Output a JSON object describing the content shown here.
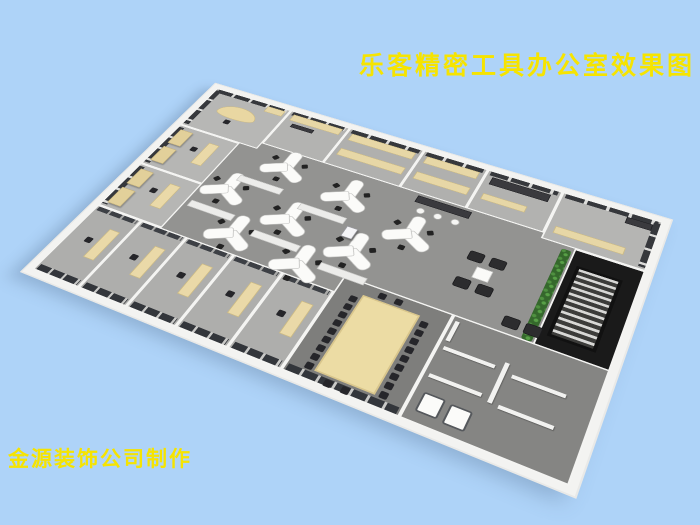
{
  "title": {
    "text": "乐客精密工具办公室效果图",
    "color": "#f6e400"
  },
  "credit": {
    "text": "金源装饰公司制作",
    "color": "#f6e400"
  },
  "palette": {
    "background": "#aed3f8",
    "wall_white": "#f3f3f1",
    "floor_open": "#939391",
    "floor_office": "#b4b4b2",
    "floor_conference": "#7e7e7c",
    "glass_dark": "#3a3d42",
    "furniture_wood": "#e7d7a6",
    "plant_green": "#3c7a30",
    "chair_black": "#26262a"
  },
  "scene": {
    "camera": {
      "perspective": 900,
      "rotateX": 45,
      "rotateZ": 26,
      "scale": 0.84,
      "left": 28,
      "top": 37,
      "w": 640,
      "h": 400
    },
    "rooms": [
      {
        "name": "room-manager-nw",
        "x": 0,
        "y": 0,
        "w": 122,
        "h": 95,
        "floor": "#b7b7b5",
        "cls": "win-n win-w"
      },
      {
        "name": "room-office-n1",
        "x": 122,
        "y": 0,
        "w": 92,
        "h": 82,
        "floor": "#b3b3b1",
        "cls": "win-n"
      },
      {
        "name": "room-storage-n1",
        "x": 214,
        "y": 0,
        "w": 110,
        "h": 82,
        "floor": "#b0b0ae",
        "cls": "win-n"
      },
      {
        "name": "room-storage-n2",
        "x": 324,
        "y": 0,
        "w": 90,
        "h": 82,
        "floor": "#b0b0ae",
        "cls": "win-n"
      },
      {
        "name": "room-office-n2",
        "x": 414,
        "y": 0,
        "w": 100,
        "h": 82,
        "floor": "#b2b2b0",
        "cls": "win-n"
      },
      {
        "name": "room-ne",
        "x": 514,
        "y": 0,
        "w": 126,
        "h": 92,
        "floor": "#b5b5b3",
        "cls": "win-n win-e"
      },
      {
        "name": "room-office-w1",
        "x": 0,
        "y": 95,
        "w": 95,
        "h": 92,
        "floor": "#b6b6b4",
        "cls": "win-w"
      },
      {
        "name": "room-office-w2",
        "x": 0,
        "y": 187,
        "w": 95,
        "h": 90,
        "floor": "#b6b6b4",
        "cls": "win-w"
      },
      {
        "name": "room-office-s1",
        "x": 0,
        "y": 277,
        "w": 66,
        "h": 123,
        "floor": "#aeaeac",
        "cls": "glass-n glass-s"
      },
      {
        "name": "room-office-s2",
        "x": 66,
        "y": 277,
        "w": 66,
        "h": 123,
        "floor": "#aeaeac",
        "cls": "glass-n glass-s"
      },
      {
        "name": "room-office-s3",
        "x": 132,
        "y": 277,
        "w": 66,
        "h": 123,
        "floor": "#aeaeac",
        "cls": "glass-n glass-s"
      },
      {
        "name": "room-office-s4",
        "x": 198,
        "y": 277,
        "w": 66,
        "h": 123,
        "floor": "#aeaeac",
        "cls": "glass-n glass-s"
      },
      {
        "name": "room-office-s5",
        "x": 264,
        "y": 277,
        "w": 66,
        "h": 123,
        "floor": "#aeaeac",
        "cls": "glass-n glass-s"
      },
      {
        "name": "room-conference",
        "x": 330,
        "y": 250,
        "w": 135,
        "h": 150,
        "floor": "#7e7e7c",
        "cls": "glass-s"
      },
      {
        "name": "room-restrooms-se",
        "x": 465,
        "y": 250,
        "w": 175,
        "h": 150,
        "floor": "#858583",
        "cls": ""
      },
      {
        "name": "room-stairwell",
        "x": 556,
        "y": 92,
        "w": 84,
        "h": 160,
        "floor": "#1a1a1a",
        "cls": ""
      }
    ],
    "items": [
      {
        "type": "curvedesk",
        "name": "reception-curved-desk",
        "x": 28,
        "y": 26,
        "w": 60,
        "h": 28
      },
      {
        "type": "chair",
        "name": "office-chair",
        "x": 50,
        "y": 58
      },
      {
        "type": "shelf",
        "name": "sideboard",
        "x": 88,
        "y": 6,
        "w": 28,
        "h": 13
      },
      {
        "type": "shelf",
        "name": "sideboard",
        "x": 130,
        "y": 7,
        "w": 76,
        "h": 14
      },
      {
        "type": "counter",
        "name": "dark-counter",
        "x": 138,
        "y": 26,
        "w": 34,
        "h": 8
      },
      {
        "type": "shelf",
        "name": "storage-shelf",
        "x": 222,
        "y": 10,
        "w": 94,
        "h": 15
      },
      {
        "type": "shelf",
        "name": "storage-shelf",
        "x": 222,
        "y": 44,
        "w": 94,
        "h": 15
      },
      {
        "type": "shelf",
        "name": "storage-shelf",
        "x": 332,
        "y": 10,
        "w": 74,
        "h": 15
      },
      {
        "type": "shelf",
        "name": "storage-shelf",
        "x": 332,
        "y": 44,
        "w": 74,
        "h": 15
      },
      {
        "type": "darkdesk",
        "name": "dark-desk",
        "x": 424,
        "y": 12,
        "w": 78,
        "h": 15
      },
      {
        "type": "shelf",
        "name": "storage-shelf",
        "x": 424,
        "y": 46,
        "w": 58,
        "h": 12
      },
      {
        "type": "shelf",
        "name": "sideboard",
        "x": 524,
        "y": 64,
        "w": 86,
        "h": 13
      },
      {
        "type": "darkdesk",
        "name": "dark-desk",
        "x": 598,
        "y": 10,
        "w": 32,
        "h": 12
      },
      {
        "type": "cabinet",
        "name": "wardrobe-cabinet",
        "x": 7,
        "y": 104,
        "w": 20,
        "h": 32,
        "repeat": 2,
        "dx": 0,
        "dy": 40
      },
      {
        "type": "desk",
        "name": "office-desk",
        "x": 58,
        "y": 112,
        "w": 16,
        "h": 46
      },
      {
        "type": "chair",
        "name": "office-chair",
        "x": 42,
        "y": 128
      },
      {
        "type": "cabinet",
        "name": "wardrobe-cabinet",
        "x": 7,
        "y": 196,
        "w": 20,
        "h": 32,
        "repeat": 2,
        "dx": 0,
        "dy": 40
      },
      {
        "type": "desk",
        "name": "office-desk",
        "x": 58,
        "y": 204,
        "w": 16,
        "h": 46
      },
      {
        "type": "chair",
        "name": "office-chair",
        "x": 42,
        "y": 220
      },
      {
        "type": "desk",
        "name": "office-desk",
        "x": 40,
        "y": 306,
        "w": 15,
        "h": 52,
        "repeat": 5,
        "dx": 66,
        "dy": 0
      },
      {
        "type": "chair",
        "name": "office-chair",
        "x": 24,
        "y": 328,
        "repeat": 5,
        "dx": 66,
        "dy": 0
      },
      {
        "type": "ydesk",
        "name": "y-workstation",
        "x": 175,
        "y": 112
      },
      {
        "type": "ydesk",
        "name": "y-workstation",
        "x": 272,
        "y": 127
      },
      {
        "type": "ydesk",
        "name": "y-workstation",
        "x": 370,
        "y": 155
      },
      {
        "type": "ydesk",
        "name": "y-workstation",
        "x": 128,
        "y": 182
      },
      {
        "type": "ydesk",
        "name": "y-workstation",
        "x": 225,
        "y": 197
      },
      {
        "type": "ydesk",
        "name": "y-workstation",
        "x": 320,
        "y": 212
      },
      {
        "type": "ydesk",
        "name": "y-workstation",
        "x": 176,
        "y": 248
      },
      {
        "type": "ydesk",
        "name": "y-workstation",
        "x": 272,
        "y": 258
      },
      {
        "type": "lowcab",
        "name": "low-cabinet",
        "x": 130,
        "y": 150,
        "w": 64,
        "h": 12
      },
      {
        "type": "lowcab",
        "name": "low-cabinet",
        "x": 226,
        "y": 163,
        "w": 64,
        "h": 12
      },
      {
        "type": "lowcab",
        "name": "low-cabinet",
        "x": 100,
        "y": 218,
        "w": 64,
        "h": 12
      },
      {
        "type": "lowcab",
        "name": "low-cabinet",
        "x": 198,
        "y": 230,
        "w": 64,
        "h": 12
      },
      {
        "type": "lowcab",
        "name": "low-cabinet",
        "x": 296,
        "y": 243,
        "w": 60,
        "h": 12
      },
      {
        "type": "printer",
        "name": "copier-machine",
        "x": 296,
        "y": 175,
        "w": 15,
        "h": 19
      },
      {
        "type": "counter",
        "name": "bar-counter",
        "x": 352,
        "y": 86,
        "w": 72,
        "h": 13
      },
      {
        "type": "stool",
        "name": "bar-stool",
        "x": 360,
        "y": 106,
        "repeat": 3,
        "dx": 23,
        "dy": 0
      },
      {
        "type": "armchair",
        "name": "lounge-armchair",
        "x": 446,
        "y": 148,
        "repeat": 2,
        "dx": 27,
        "dy": 0
      },
      {
        "type": "armchair",
        "name": "lounge-armchair",
        "x": 446,
        "y": 194,
        "repeat": 2,
        "dx": 27,
        "dy": 0
      },
      {
        "type": "ctable",
        "name": "coffee-table",
        "x": 462,
        "y": 170,
        "w": 20,
        "h": 19
      },
      {
        "type": "plant",
        "name": "green-plant-wall",
        "x": 542,
        "y": 98,
        "w": 12,
        "h": 152
      },
      {
        "type": "stairs",
        "name": "staircase",
        "x": 566,
        "y": 118,
        "w": 54,
        "h": 116
      },
      {
        "type": "armchair",
        "name": "waiting-armchair",
        "x": 516,
        "y": 226,
        "repeat": 2,
        "dx": 25,
        "dy": 0
      },
      {
        "type": "conftable",
        "name": "conference-table",
        "x": 362,
        "y": 268,
        "w": 70,
        "h": 118
      },
      {
        "type": "chair",
        "name": "conference-chair",
        "x": 350,
        "y": 274,
        "repeat": 9,
        "dx": 0,
        "dy": 13
      },
      {
        "type": "chair",
        "name": "conference-chair",
        "x": 436,
        "y": 274,
        "repeat": 9,
        "dx": 0,
        "dy": 13
      },
      {
        "type": "chair",
        "name": "conference-chair",
        "x": 378,
        "y": 256,
        "repeat": 2,
        "dx": 20,
        "dy": 0
      },
      {
        "type": "chair",
        "name": "conference-chair",
        "x": 378,
        "y": 390,
        "repeat": 2,
        "dx": 20,
        "dy": 0
      },
      {
        "type": "partition",
        "name": "stall-partition",
        "x": 470,
        "y": 258,
        "w": 5,
        "h": 30
      },
      {
        "type": "partition",
        "name": "stall-partition",
        "x": 472,
        "y": 296,
        "w": 58,
        "h": 5
      },
      {
        "type": "partition",
        "name": "stall-partition",
        "x": 472,
        "y": 336,
        "w": 58,
        "h": 5
      },
      {
        "type": "partition",
        "name": "stall-partition",
        "x": 538,
        "y": 288,
        "w": 5,
        "h": 56
      },
      {
        "type": "partition",
        "name": "stall-partition",
        "x": 550,
        "y": 300,
        "w": 58,
        "h": 5
      },
      {
        "type": "partition",
        "name": "stall-partition",
        "x": 550,
        "y": 342,
        "w": 58,
        "h": 5
      },
      {
        "type": "toilet",
        "name": "toilet",
        "x": 476,
        "y": 360,
        "w": 24,
        "h": 26
      },
      {
        "type": "toilet",
        "name": "toilet",
        "x": 506,
        "y": 362,
        "w": 24,
        "h": 26
      }
    ]
  }
}
